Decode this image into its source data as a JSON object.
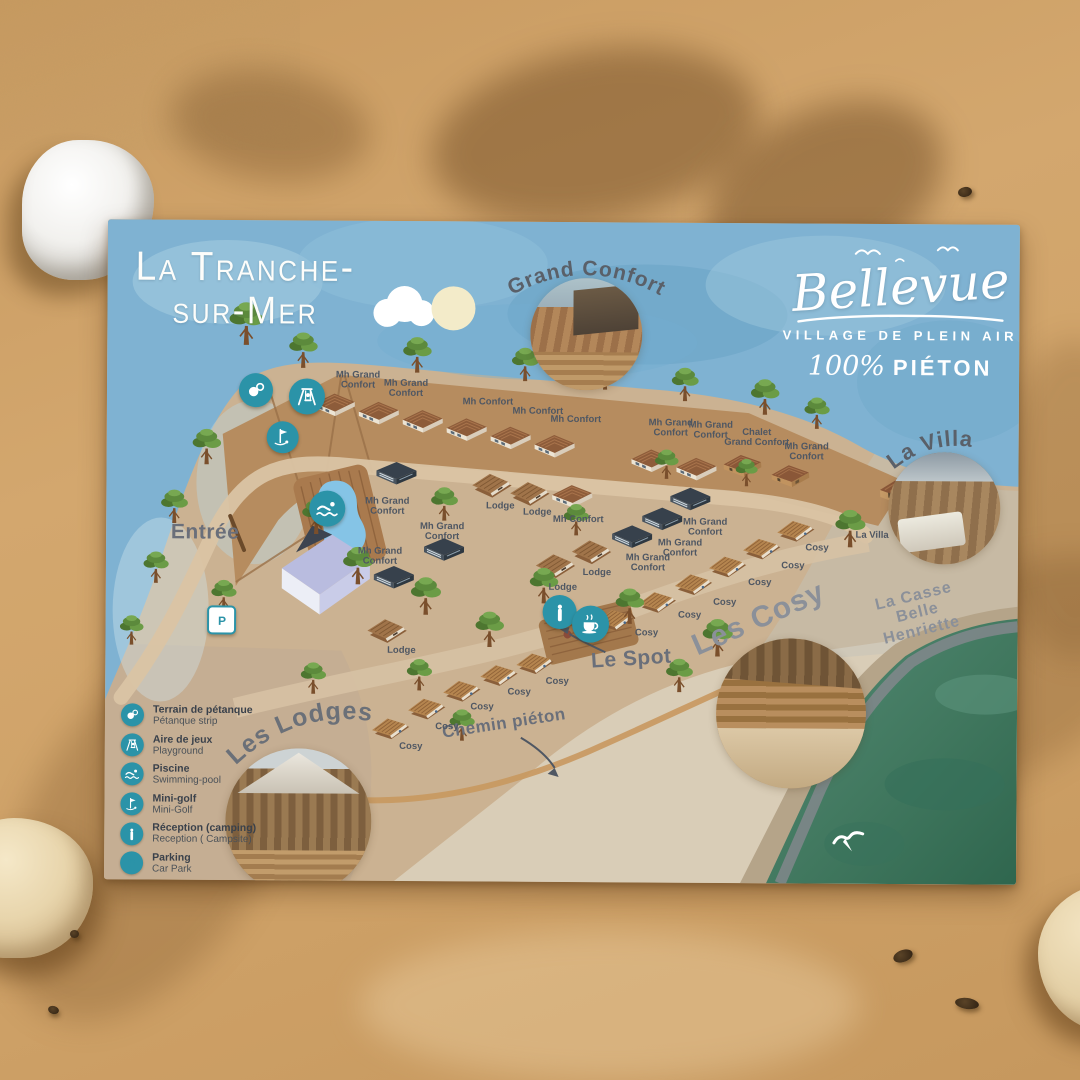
{
  "colors": {
    "teal": "#2b93a8",
    "sand": "#c99c63",
    "sea": "#41785f",
    "sky": "#7fb2d2",
    "ground": "#cbb292"
  },
  "title": {
    "line1": "La Tranche-",
    "line2": "sur-Mer"
  },
  "brand": {
    "name": "Bellevue",
    "subtitle": "VILLAGE DE PLEIN AIR",
    "tagline_script": "100%",
    "tagline_text": "PIÉTON"
  },
  "insets": {
    "grand_confort": {
      "label": "Grand Confort"
    },
    "la_villa": {
      "label": "La Villa"
    },
    "les_lodges": {
      "label": "Les Lodges"
    }
  },
  "legend": {
    "items": [
      {
        "icon": "petanque-icon",
        "fr": "Terrain de pétanque",
        "en": "Pétanque strip"
      },
      {
        "icon": "playground-icon",
        "fr": "Aire de jeux",
        "en": "Playground"
      },
      {
        "icon": "swimmer-icon",
        "fr": "Piscine",
        "en": "Swimming-pool"
      },
      {
        "icon": "minigolf-icon",
        "fr": "Mini-golf",
        "en": "Mini-Golf"
      },
      {
        "icon": "info-icon",
        "fr": "Réception (camping)",
        "en": "Reception ( Campsite)"
      },
      {
        "icon": "parking-icon",
        "fr": "Parking",
        "en": "Car  Park",
        "variant": "square"
      },
      {
        "icon": "coffee-icon",
        "fr": "Le Spot",
        "en": "",
        "cls": "mt"
      }
    ]
  },
  "map_icons": [
    {
      "icon": "petanque-icon",
      "x": 149,
      "y": 170,
      "d": 34
    },
    {
      "icon": "playground-icon",
      "x": 200,
      "y": 176,
      "d": 36
    },
    {
      "icon": "minigolf-icon",
      "x": 176,
      "y": 217,
      "d": 32
    },
    {
      "icon": "swimmer-icon",
      "x": 221,
      "y": 288,
      "d": 36
    },
    {
      "icon": "parking-icon",
      "x": 116,
      "y": 400,
      "d": 25,
      "variant": "square"
    },
    {
      "icon": "info-icon",
      "x": 454,
      "y": 390,
      "d": 34
    },
    {
      "icon": "coffee-icon",
      "x": 485,
      "y": 402,
      "d": 37
    }
  ],
  "map_labels": [
    {
      "t": "Entrée",
      "x": 99,
      "y": 313,
      "s": 21,
      "r": 0,
      "cls": "lbl-place"
    },
    {
      "t": "Le Spot",
      "x": 526,
      "y": 437,
      "s": 21,
      "r": -4,
      "cls": "lbl-place"
    },
    {
      "t": "Chemin piéton",
      "x": 399,
      "y": 502,
      "s": 17,
      "r": -9,
      "cls": "lbl-place"
    },
    {
      "t": "Les Cosy",
      "x": 653,
      "y": 396,
      "s": 30,
      "r": -24,
      "cls": "lbl-area"
    },
    {
      "t": "La Casse Belle Henriette",
      "x": 812,
      "y": 389,
      "s": 16,
      "r": -14,
      "cls": "lbl-area"
    },
    {
      "t": "La Villa",
      "x": 766,
      "y": 312,
      "s": 9.5,
      "r": 0
    },
    {
      "t": "Mh Grand\nConfort",
      "x": 251,
      "y": 160,
      "s": 9.5
    },
    {
      "t": "Mh Grand\nConfort",
      "x": 299,
      "y": 168,
      "s": 9.5
    },
    {
      "t": "Mh Confort",
      "x": 381,
      "y": 181,
      "s": 9.5
    },
    {
      "t": "Mh Confort",
      "x": 431,
      "y": 190,
      "s": 9.5
    },
    {
      "t": "Mh Confort",
      "x": 469,
      "y": 198,
      "s": 9.5
    },
    {
      "t": "Mh Grand\nConfort",
      "x": 564,
      "y": 206,
      "s": 9.5
    },
    {
      "t": "Mh Grand\nConfort",
      "x": 604,
      "y": 208,
      "s": 9.5
    },
    {
      "t": "Chalet\nGrand Confort",
      "x": 650,
      "y": 215,
      "s": 9.5
    },
    {
      "t": "Mh Grand\nConfort",
      "x": 700,
      "y": 229,
      "s": 9.5
    },
    {
      "t": "Mh Grand\nConfort",
      "x": 281,
      "y": 286,
      "s": 9.5
    },
    {
      "t": "Mh Grand\nConfort",
      "x": 336,
      "y": 311,
      "s": 9.5
    },
    {
      "t": "Mh Grand\nConfort",
      "x": 274,
      "y": 336,
      "s": 9.5
    },
    {
      "t": "Lodge",
      "x": 394,
      "y": 285,
      "s": 9.5
    },
    {
      "t": "Lodge",
      "x": 431,
      "y": 291,
      "s": 9.5
    },
    {
      "t": "Mh Confort",
      "x": 472,
      "y": 298,
      "s": 9.5
    },
    {
      "t": "Lodge",
      "x": 457,
      "y": 366,
      "s": 9.5
    },
    {
      "t": "Lodge",
      "x": 491,
      "y": 351,
      "s": 9.5
    },
    {
      "t": "Lodge",
      "x": 296,
      "y": 430,
      "s": 9.5
    },
    {
      "t": "Mh Grand\nConfort",
      "x": 599,
      "y": 305,
      "s": 9.5
    },
    {
      "t": "Mh Grand\nConfort",
      "x": 574,
      "y": 326,
      "s": 9.5
    },
    {
      "t": "Mh Grand\nConfort",
      "x": 542,
      "y": 341,
      "s": 9.5
    },
    {
      "t": "Cosy",
      "x": 711,
      "y": 325,
      "s": 9.5
    },
    {
      "t": "Cosy",
      "x": 687,
      "y": 343,
      "s": 9.5
    },
    {
      "t": "Cosy",
      "x": 654,
      "y": 360,
      "s": 9.5
    },
    {
      "t": "Cosy",
      "x": 619,
      "y": 380,
      "s": 9.5
    },
    {
      "t": "Cosy",
      "x": 584,
      "y": 393,
      "s": 9.5
    },
    {
      "t": "Cosy",
      "x": 541,
      "y": 411,
      "s": 9.5
    },
    {
      "t": "Cosy",
      "x": 452,
      "y": 460,
      "s": 9.5
    },
    {
      "t": "Cosy",
      "x": 414,
      "y": 471,
      "s": 9.5
    },
    {
      "t": "Cosy",
      "x": 377,
      "y": 486,
      "s": 9.5
    },
    {
      "t": "Cosy",
      "x": 342,
      "y": 506,
      "s": 9.5
    },
    {
      "t": "Cosy",
      "x": 306,
      "y": 526,
      "s": 9.5
    }
  ],
  "cabins": [
    {
      "type": "confort",
      "x": 228,
      "y": 186,
      "r": -2
    },
    {
      "type": "confort",
      "x": 272,
      "y": 194,
      "r": -2
    },
    {
      "type": "confort",
      "x": 316,
      "y": 202,
      "r": -2
    },
    {
      "type": "confort",
      "x": 360,
      "y": 210,
      "r": -2
    },
    {
      "type": "confort",
      "x": 404,
      "y": 218,
      "r": -2
    },
    {
      "type": "confort",
      "x": 448,
      "y": 226,
      "r": -2
    },
    {
      "type": "confort",
      "x": 545,
      "y": 240,
      "r": -2
    },
    {
      "type": "confort",
      "x": 590,
      "y": 248,
      "r": -2
    },
    {
      "type": "chalet",
      "x": 636,
      "y": 244,
      "r": -4
    },
    {
      "type": "chalet",
      "x": 684,
      "y": 254,
      "r": -4
    },
    {
      "type": "mh",
      "x": 290,
      "y": 254,
      "r": 0
    },
    {
      "type": "mh",
      "x": 338,
      "y": 330,
      "r": 0
    },
    {
      "type": "mh",
      "x": 288,
      "y": 358,
      "r": 0
    },
    {
      "type": "mh",
      "x": 584,
      "y": 278,
      "r": 0
    },
    {
      "type": "mh",
      "x": 556,
      "y": 298,
      "r": 0
    },
    {
      "type": "mh",
      "x": 526,
      "y": 316,
      "r": 0
    },
    {
      "type": "confort",
      "x": 466,
      "y": 276,
      "r": -3
    },
    {
      "type": "lodge",
      "x": 386,
      "y": 262,
      "r": 0
    },
    {
      "type": "lodge",
      "x": 424,
      "y": 270,
      "r": 0
    },
    {
      "type": "lodge",
      "x": 450,
      "y": 342,
      "r": 0
    },
    {
      "type": "lodge",
      "x": 486,
      "y": 328,
      "r": 0
    },
    {
      "type": "lodge",
      "x": 282,
      "y": 408,
      "r": 0
    },
    {
      "type": "cosy",
      "x": 690,
      "y": 306,
      "r": -6
    },
    {
      "type": "cosy",
      "x": 656,
      "y": 324,
      "r": -6
    },
    {
      "type": "cosy",
      "x": 622,
      "y": 342,
      "r": -6
    },
    {
      "type": "cosy",
      "x": 588,
      "y": 360,
      "r": -6
    },
    {
      "type": "cosy",
      "x": 552,
      "y": 378,
      "r": -6
    },
    {
      "type": "cosy",
      "x": 510,
      "y": 396,
      "r": -6
    },
    {
      "type": "cosy",
      "x": 430,
      "y": 440,
      "r": -6
    },
    {
      "type": "cosy",
      "x": 394,
      "y": 452,
      "r": -6
    },
    {
      "type": "cosy",
      "x": 357,
      "y": 468,
      "r": -6
    },
    {
      "type": "cosy",
      "x": 322,
      "y": 486,
      "r": -6
    },
    {
      "type": "cosy",
      "x": 286,
      "y": 506,
      "r": -6
    },
    {
      "type": "villa",
      "x": 818,
      "y": 272,
      "r": -4
    }
  ],
  "trees": [
    {
      "x": 139,
      "y": 123,
      "s": 42
    },
    {
      "x": 196,
      "y": 146,
      "s": 35
    },
    {
      "x": 310,
      "y": 150,
      "s": 35
    },
    {
      "x": 418,
      "y": 158,
      "s": 33
    },
    {
      "x": 498,
      "y": 166,
      "s": 33
    },
    {
      "x": 578,
      "y": 177,
      "s": 33
    },
    {
      "x": 658,
      "y": 190,
      "s": 35
    },
    {
      "x": 710,
      "y": 204,
      "s": 31
    },
    {
      "x": 100,
      "y": 243,
      "s": 35
    },
    {
      "x": 68,
      "y": 302,
      "s": 33
    },
    {
      "x": 50,
      "y": 362,
      "s": 31
    },
    {
      "x": 26,
      "y": 424,
      "s": 29
    },
    {
      "x": 118,
      "y": 390,
      "s": 31
    },
    {
      "x": 210,
      "y": 312,
      "s": 35
    },
    {
      "x": 252,
      "y": 362,
      "s": 37
    },
    {
      "x": 338,
      "y": 298,
      "s": 33
    },
    {
      "x": 320,
      "y": 392,
      "s": 37
    },
    {
      "x": 384,
      "y": 424,
      "s": 35
    },
    {
      "x": 438,
      "y": 380,
      "s": 35
    },
    {
      "x": 470,
      "y": 312,
      "s": 31
    },
    {
      "x": 524,
      "y": 400,
      "s": 35
    },
    {
      "x": 612,
      "y": 432,
      "s": 37
    },
    {
      "x": 744,
      "y": 322,
      "s": 37
    },
    {
      "x": 560,
      "y": 255,
      "s": 29
    },
    {
      "x": 640,
      "y": 262,
      "s": 27
    },
    {
      "x": 574,
      "y": 468,
      "s": 33
    },
    {
      "x": 654,
      "y": 493,
      "s": 33
    },
    {
      "x": 357,
      "y": 518,
      "s": 31
    },
    {
      "x": 314,
      "y": 468,
      "s": 31
    },
    {
      "x": 208,
      "y": 472,
      "s": 31
    }
  ],
  "pebbles": [
    {
      "x": 893,
      "y": 950,
      "w": 20,
      "h": 12,
      "r": -20
    },
    {
      "x": 955,
      "y": 998,
      "w": 24,
      "h": 11,
      "r": 8
    },
    {
      "x": 70,
      "y": 930,
      "w": 9,
      "h": 8,
      "r": 0
    },
    {
      "x": 48,
      "y": 1006,
      "w": 11,
      "h": 8,
      "r": 15
    },
    {
      "x": 958,
      "y": 187,
      "w": 14,
      "h": 10,
      "r": -10
    }
  ]
}
